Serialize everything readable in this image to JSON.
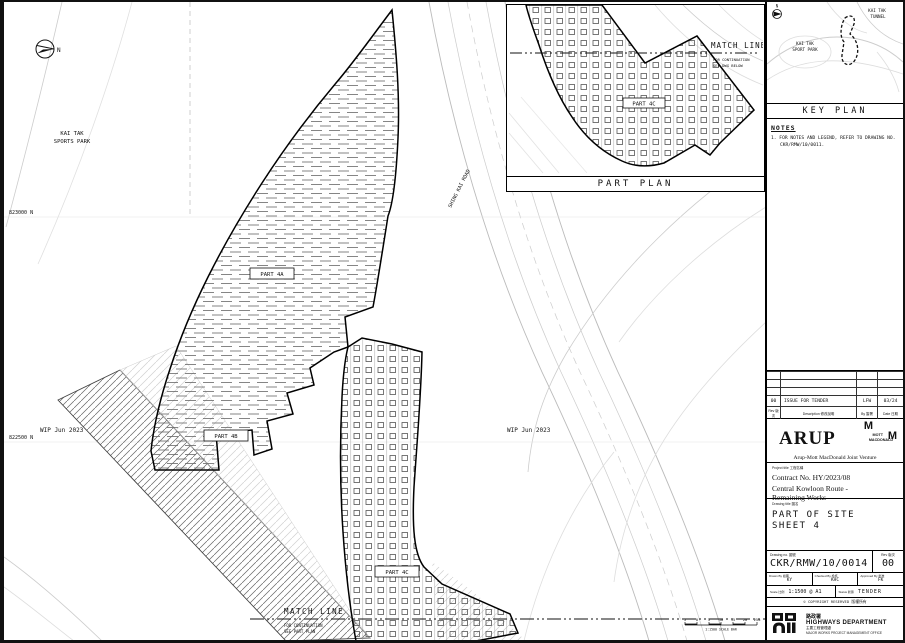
{
  "plan": {
    "north": "N",
    "park_label_1": "KAI TAK",
    "park_label_2": "SPORTS PARK",
    "grid_north_1": "823000 N",
    "grid_north_2": "822500 N",
    "watermark_left": "WIP Jun 2023",
    "watermark_right": "WIP Jun 2023",
    "road_label": "SHING KAI ROAD",
    "part_4a": "PART 4A",
    "part_4b": "PART 4B",
    "part_4c": "PART 4C",
    "match_line_bottom": {
      "title": "MATCH LINE",
      "note_1": "FOR CONTINUATION",
      "note_2": "SEE PART PLAN"
    }
  },
  "part_plan_inset": {
    "title": "PART PLAN",
    "part_label": "PART 4C",
    "match_line": {
      "title": "MATCH LINE",
      "note_1": "FOR CONTINUATION",
      "note_2": "SEE DWG BELOW"
    }
  },
  "key_plan": {
    "title": "KEY PLAN",
    "north": "N",
    "park_label_1": "KAI TAK",
    "park_label_2": "SPORT PARK",
    "tunnel_label_1": "KAI TAK",
    "tunnel_label_2": "TUNNEL"
  },
  "notes": {
    "heading": "NOTES",
    "item_1a": "1. FOR NOTES AND LEGEND, REFER TO DRAWING NO.",
    "item_1b": "CKR/RMW/10/0011."
  },
  "revisions": {
    "headers": {
      "rev": "Rev 版次",
      "description": "Description 修改說明",
      "by": "By 簽署",
      "date": "Date 日期"
    },
    "rows": [
      {
        "rev": "00",
        "description": "ISSUE FOR TENDER",
        "by": "LFW",
        "date": "03/24"
      }
    ]
  },
  "firm": {
    "arup": "ARUP",
    "mott_m1": "M",
    "mott_m2": "M",
    "mott_name_1": "MOTT",
    "mott_name_2": "MACDONALD",
    "joint_venture": "Arup-Mott MacDonald Joint Venture"
  },
  "title_block": {
    "project_label": "Project title 工程名稱",
    "contract_no": "Contract No. HY/2023/08",
    "project_name_1": "Central Kowloon Route -",
    "project_name_2": "Remaining Works",
    "drawing_label": "Drawing title 圖名",
    "drawing_title_1": "PART OF SITE",
    "drawing_title_2": "SHEET 4",
    "drawing_no_label": "Drawing no. 圖號",
    "drawing_no": "CKR/RMW/10/0014",
    "rev_label": "Rev 版次",
    "rev": "00",
    "drawn_label": "Drawn By 繪圖",
    "drawn": "KY",
    "checked_label": "Checked By 檢核",
    "checked": "KHC",
    "approved_label": "Approved By 批准",
    "approved": "FK",
    "scale_label": "Scale 比例",
    "scale": "1:1500 @ A1",
    "status_label": "Status 狀態",
    "status": "TENDER",
    "copyright": "© COPYRIGHT RESERVED 版權所有"
  },
  "footer": {
    "dept_cn": "路政署",
    "dept_en": "HIGHWAYS DEPARTMENT",
    "office_cn": "主要工程管理處",
    "office_en": "MAJOR WORKS PROJECT MANAGEMENT OFFICE"
  },
  "scale_bar": {
    "ticks": [
      "5",
      "0",
      "5",
      "10",
      "15",
      "20",
      "25m"
    ],
    "caption": "1:1500  SCALE BAR"
  }
}
